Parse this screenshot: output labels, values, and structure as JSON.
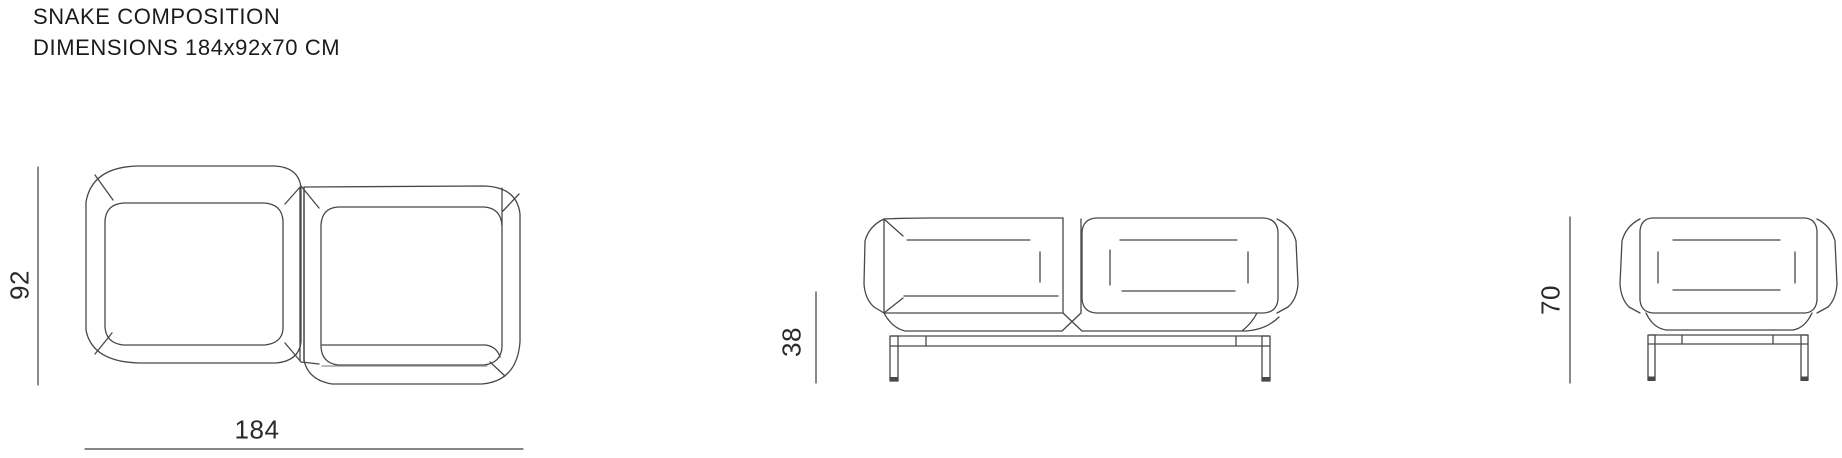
{
  "header": {
    "title": "SNAKE COMPOSITION",
    "subtitle": "DIMENSIONS 184x92x70 CM"
  },
  "dimension_labels": {
    "depth": "92",
    "width": "184",
    "seat_height": "38",
    "height": "70"
  },
  "views": {
    "top_view": "top view plan of two joined chamfered seat modules",
    "front_view": "front elevation of two-seat composition on metal base",
    "side_view": "side elevation of seat module on metal base"
  },
  "colors": {
    "line": "#484848",
    "line_light": "#909090",
    "dim_line": "#3d3d3d",
    "text": "#1b1b1b",
    "dim_text": "#2a2a2a",
    "background": "#ffffff"
  }
}
